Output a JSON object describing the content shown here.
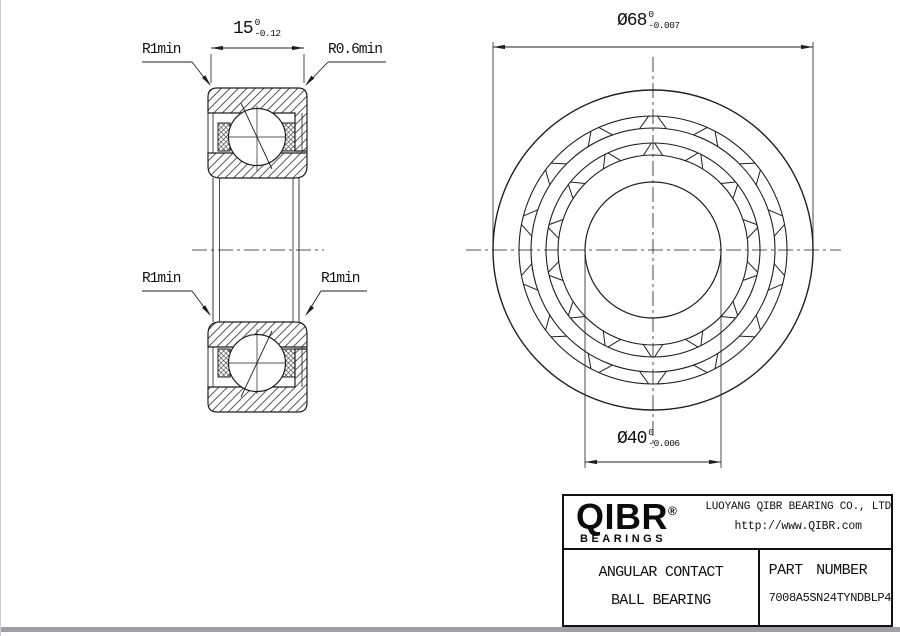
{
  "page": {
    "background": "#ffffff",
    "line_color": "#1f1f1f"
  },
  "section_view": {
    "width_dim": {
      "value": "15",
      "tol_upper": "0",
      "tol_lower": "-0.12"
    },
    "corner_labels": {
      "top_left": "R1min",
      "top_right": "R0.6min",
      "mid_left": "R1min",
      "mid_right": "R1min"
    }
  },
  "front_view": {
    "outer_dia_dim": {
      "value": "Ø68",
      "tol_upper": "0",
      "tol_lower": "-0.007"
    },
    "bore_dia_dim": {
      "value": "Ø40",
      "tol_upper": "0",
      "tol_lower": "-0.006"
    }
  },
  "title_block": {
    "brand": {
      "name": "QIBR",
      "registered_mark": "®",
      "tagline": "BEARINGS"
    },
    "company_name": "LUOYANG QIBR BEARING CO., LTD",
    "website": "http://www.QIBR.com",
    "product_type_line1": "ANGULAR CONTACT",
    "product_type_line2": "BALL BEARING",
    "part_number_label": "PART NUMBER",
    "part_number": "7008A5SN24TYNDBLP4"
  }
}
